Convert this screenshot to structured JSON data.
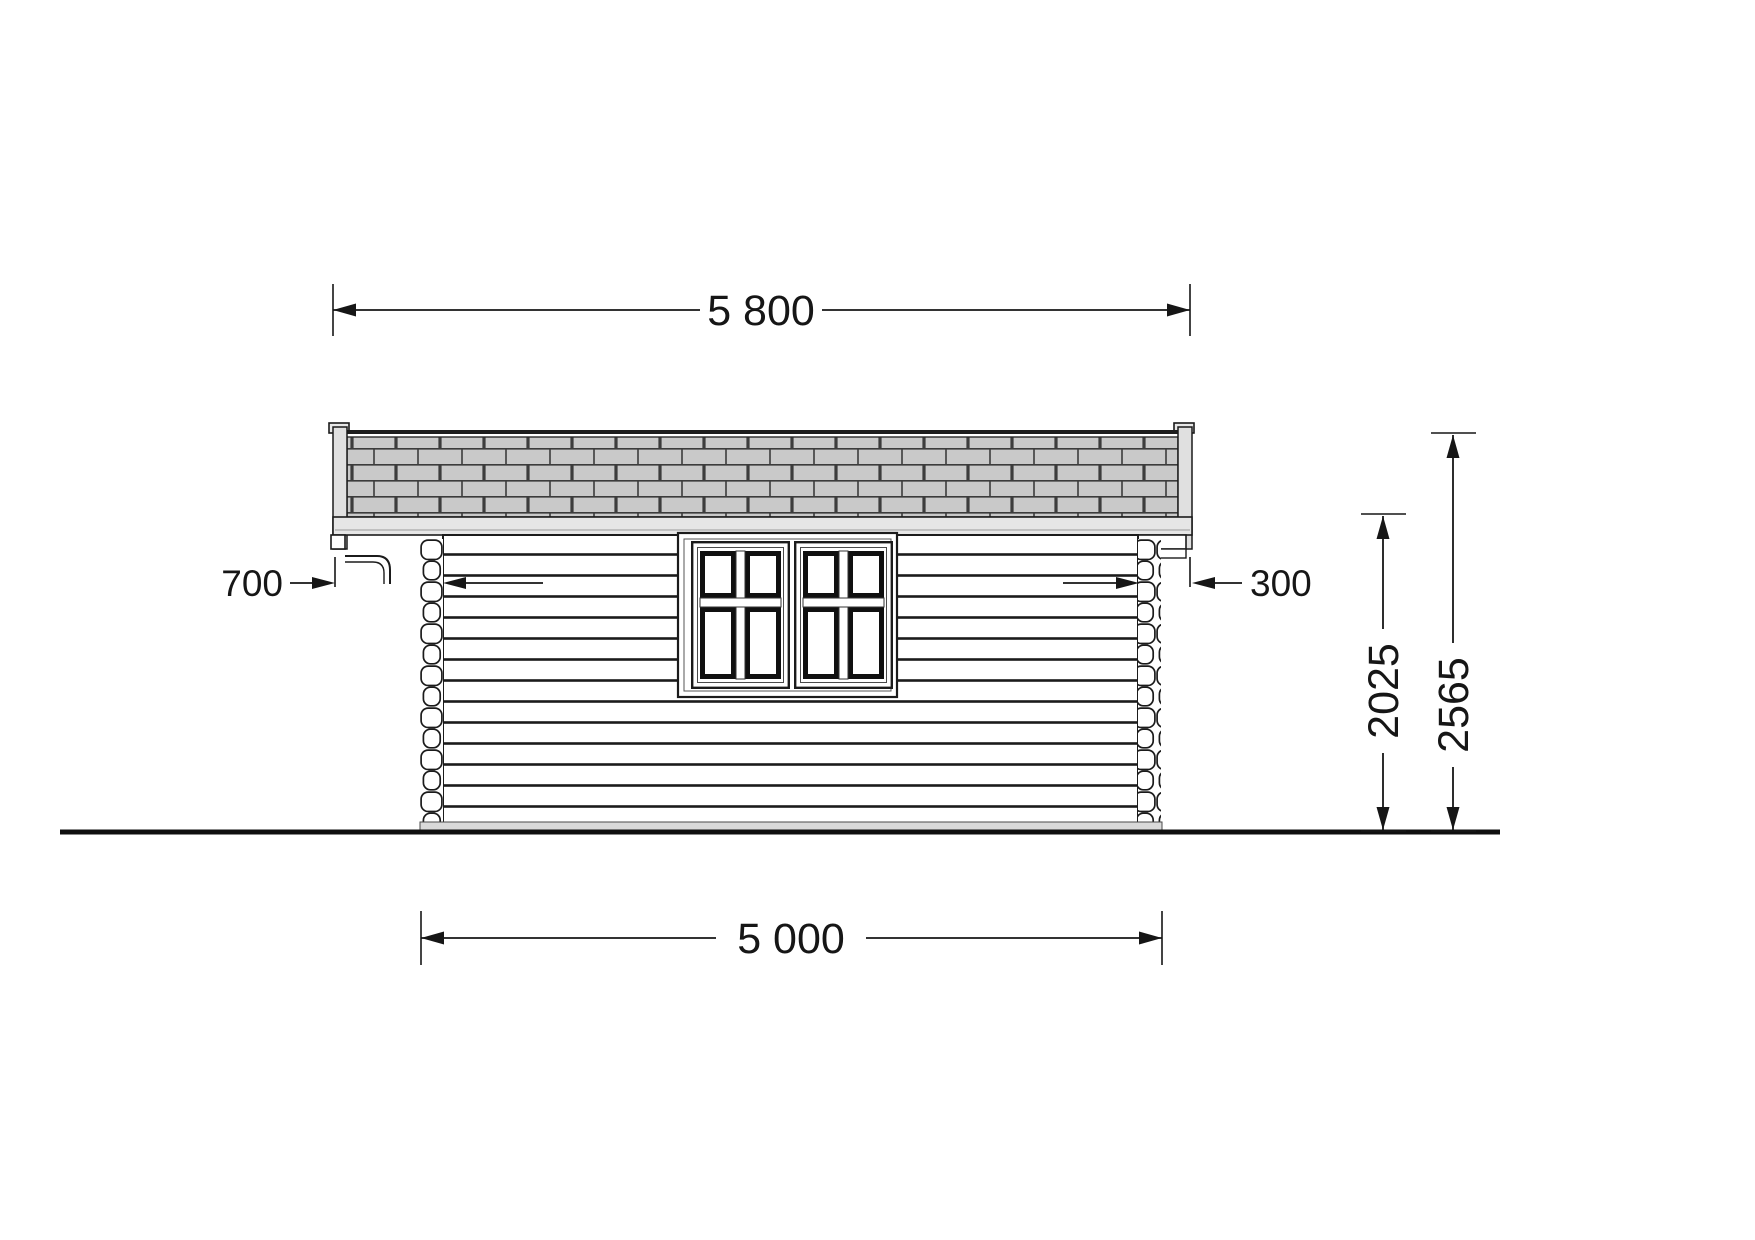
{
  "drawing": {
    "type": "cabin-side-elevation-technical-drawing",
    "background_color": "#ffffff",
    "line_color": "#1a1a1a",
    "roof_shingle_color": "#c9c9c9",
    "fascia_color": "#e6e6e6",
    "foundation_color": "#d9d9d9",
    "dimensions": {
      "roof_width": "5 800",
      "wall_width": "5 000",
      "left_overhang": "700",
      "right_overhang": "300",
      "wall_height": "2025",
      "total_height": "2565"
    }
  }
}
